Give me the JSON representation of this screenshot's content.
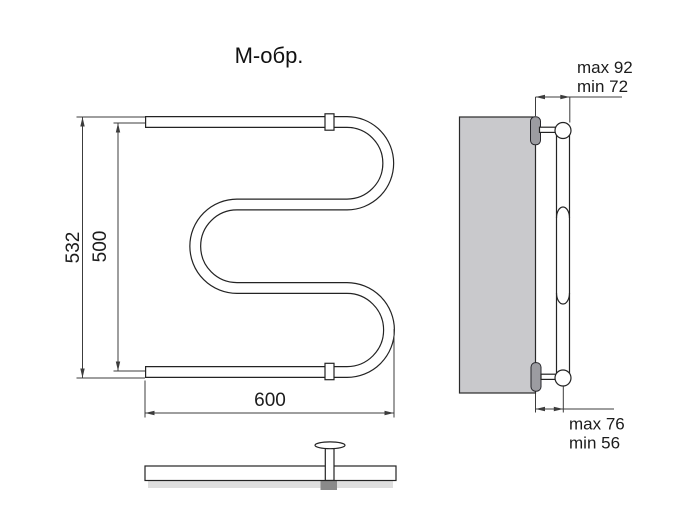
{
  "title": "М-обр.",
  "front_view": {
    "height_overall": "532",
    "height_centers": "500",
    "width": "600"
  },
  "side_view": {
    "top_clearance_max": "max 92",
    "top_clearance_min": "min 72",
    "bottom_clearance_max": "max 76",
    "bottom_clearance_min": "min 56"
  },
  "colors": {
    "line": "#232323",
    "wall_fill": "#c9c9cc",
    "plate_fill": "#9c9ca1",
    "shadow_light": "#dedede",
    "shadow_dark": "#8a8a8a"
  }
}
